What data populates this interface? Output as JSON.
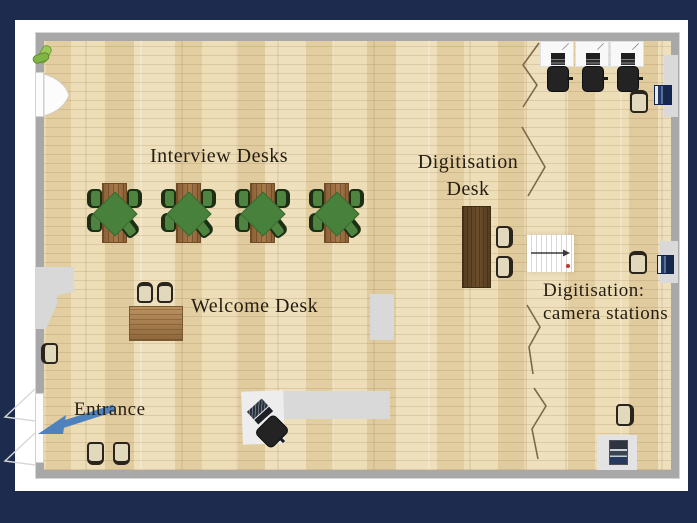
{
  "slide": {
    "background_color": "#1d2c4e",
    "canvas_color": "#ffffff"
  },
  "floorplan": {
    "wall_color": "#a8a8a8",
    "floor_color": "#e9d8af",
    "labels": {
      "interview_desks": "Interview Desks",
      "digitisation_desk": {
        "line1": "Digitisation",
        "line2": "Desk"
      },
      "welcome_desk": "Welcome Desk",
      "camera_stations": {
        "line1": "Digitisation:",
        "line2": "camera stations"
      },
      "entrance": "Entrance"
    },
    "annotation_colors": {
      "text": "#241d12",
      "entrance_arrow": "#4f81bd",
      "divider_zigzag": "#7d6a4c"
    },
    "furniture_colors": {
      "interview_table_wood": "#946a3e",
      "tablecloth_green": "#47813c",
      "interview_chair_green": "#4f8340",
      "welcome_desk_wood": "#a97f4f",
      "digitisation_desk_wood": "#5d4426",
      "guest_chair_beige": "#e2d8bc",
      "office_chair_black": "#232323",
      "camera_station_desk": "#f8f8f8",
      "mat_gray": "#d9d9d9",
      "wall_appliance_navy": "#1e3a69"
    },
    "inventory": {
      "interview_tables": 4,
      "chairs_per_interview_table": 4,
      "camera_station_desks": 3,
      "welcome_desk_chairs": 2,
      "digitisation_desk_chairs": 2,
      "entrance_waiting_chairs": 2,
      "staircases": 1
    },
    "icons": [
      "plant-icon",
      "door-swing-icon",
      "entrance-arrow-icon",
      "stairs-icon",
      "laptop-icon",
      "printer-icon",
      "wall-appliance-icon",
      "zigzag-divider-icon"
    ]
  }
}
